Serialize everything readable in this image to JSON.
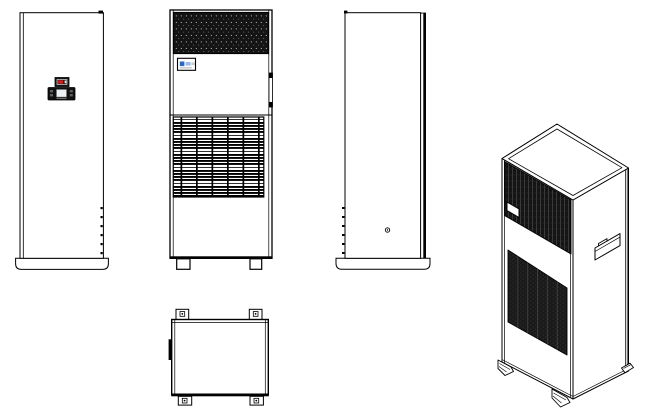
{
  "page": {
    "background": "#ffffff"
  },
  "colors": {
    "line": "#000000",
    "panel_fill": "#ffffff",
    "grille_dark": "#141414",
    "mesh_dot": "#d8d8d8",
    "display_bezel": "#141414",
    "display_red": "#cc2020",
    "lcd_screen": "#edf1f4",
    "button_gray": "#606060",
    "logo_blue": "#2f66c2",
    "logo_blue_light": "#9db9e8",
    "logo_gray": "#c9c9c9"
  },
  "drawing": {
    "type": "technical-multi-view-line-drawing",
    "subject": "floor-standing cabinet air conditioner",
    "views": [
      {
        "id": "front-view",
        "position": "top-left",
        "features": [
          "controller-indicator",
          "controller-panel",
          "lcd-screen",
          "hinge-marks",
          "base-plinth"
        ]
      },
      {
        "id": "grille-view",
        "position": "top-center",
        "features": [
          "perforated-top-grille",
          "brand-label",
          "edge-handle",
          "louvered-grille",
          "feet"
        ]
      },
      {
        "id": "side-view",
        "position": "top-right",
        "features": [
          "edge-seam",
          "hinge-marks",
          "drain-hole",
          "base-plinth"
        ]
      },
      {
        "id": "top-view",
        "position": "bottom-center",
        "features": [
          "mounting-tabs",
          "tab-holes",
          "edge-bracket"
        ]
      },
      {
        "id": "isometric-view",
        "position": "right",
        "features": [
          "top-panel",
          "front-mesh-grille",
          "brand-label",
          "intake-grille",
          "recessed-handle",
          "corner-feet"
        ]
      }
    ]
  }
}
